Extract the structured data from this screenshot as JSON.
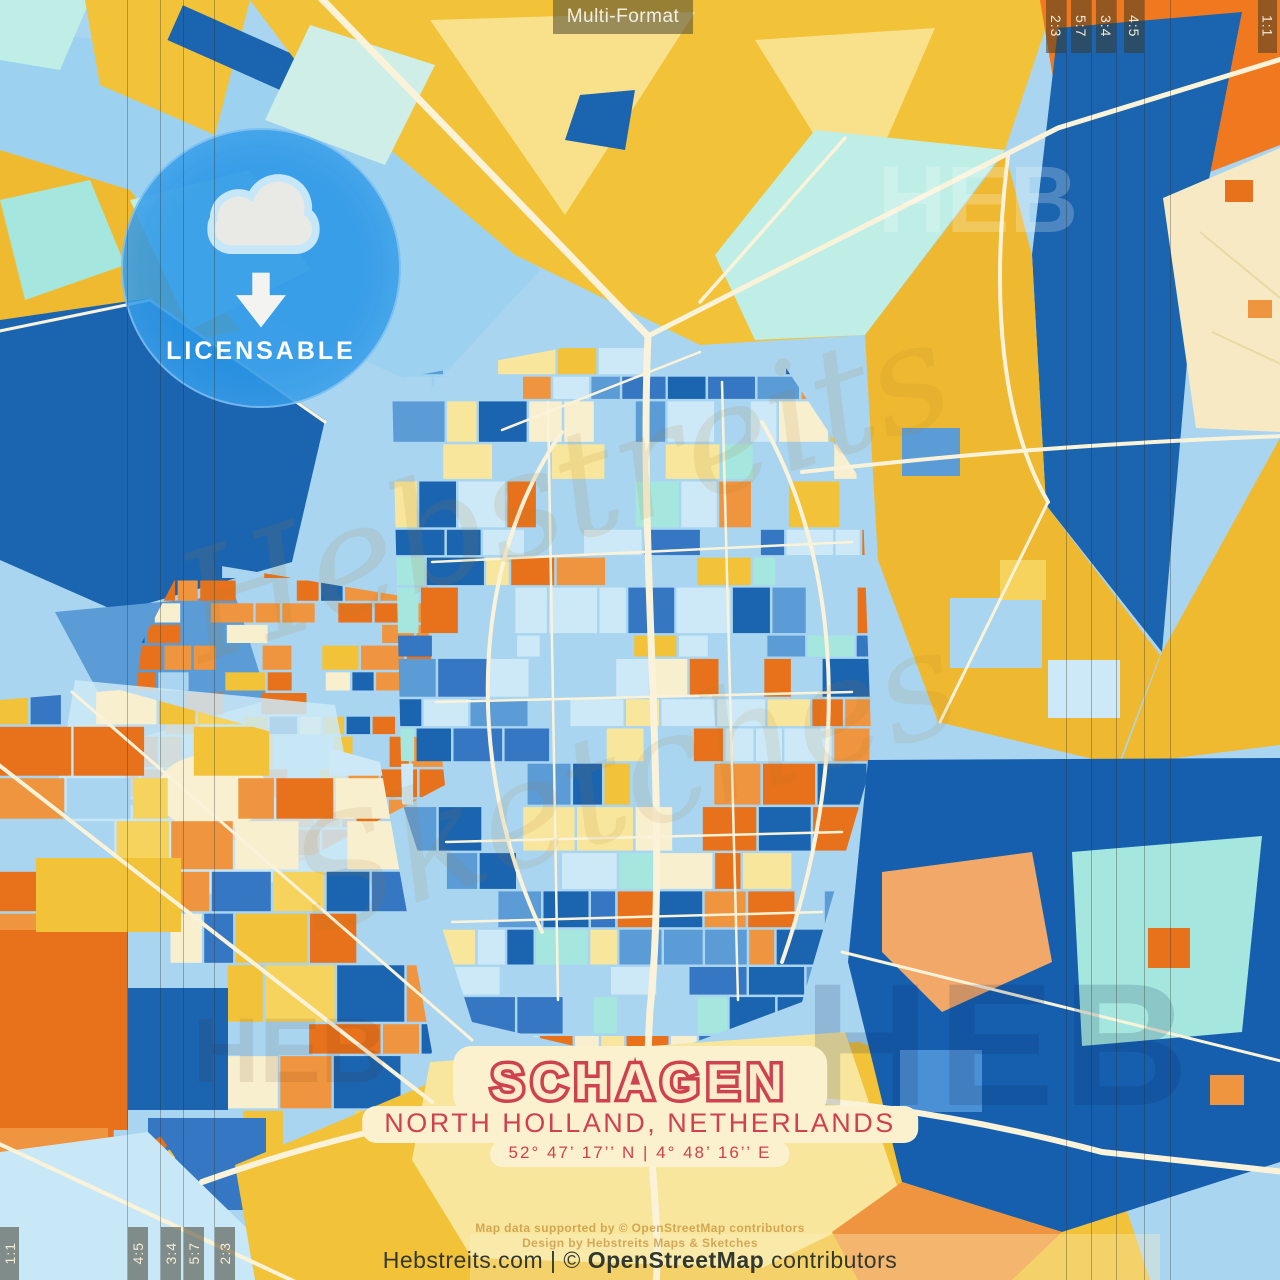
{
  "poster": {
    "top_label": "Multi-Format",
    "badge_label": "LICENSABLE",
    "title": "SCHAGEN",
    "subtitle": "NORTH HOLLAND, NETHERLANDS",
    "coordinates": "52° 47’ 17’’ N  |  4° 48’ 16’’ E"
  },
  "ratios": {
    "top_right": [
      "2:3",
      "5:7",
      "3:4",
      "4:5"
    ],
    "square": "1:1",
    "bottom_left": [
      "4:5",
      "3:4",
      "5:7",
      "2:3"
    ]
  },
  "attribution": {
    "line1": "Map data supported by © OpenStreetMap contributors",
    "line2": "Design by Hebstreits Maps & Sketches",
    "footer_prefix": "Hebstreits.com | © ",
    "footer_brand": "OpenStreetMap",
    "footer_suffix": " contributors"
  },
  "watermarks": {
    "heb": "HEB",
    "script1": "Hebstreits",
    "script2": "Sketches"
  },
  "map": {
    "palette": {
      "deep_blue": "#1b64b0",
      "medium_blue": "#3577c2",
      "sky_blue": "#5b9bd6",
      "light_blue": "#a9d5f0",
      "pale_blue": "#cde9f7",
      "aqua": "#a5e6de",
      "teal": "#bfeee6",
      "gold": "#f2c238",
      "amber": "#f0ba30",
      "yellow": "#f6d35c",
      "pale_yellow": "#f8e69c",
      "cream": "#f8efcf",
      "orange": "#e8721c",
      "light_orange": "#f0953f",
      "salmon": "#f2a869",
      "road": "#faf3da",
      "title_red": "#ce4250",
      "badge_blue": "#2997e7"
    }
  }
}
